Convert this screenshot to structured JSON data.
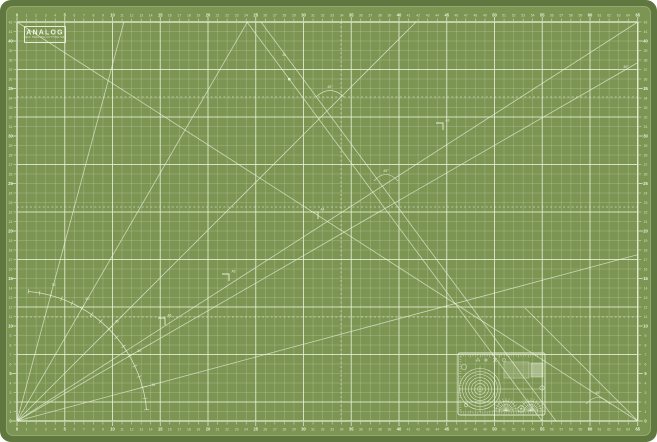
{
  "object": "self-healing cutting mat",
  "colors": {
    "frame_green": "#60783f",
    "surface_green": "#7c9553",
    "ink_white": "#edf4df"
  },
  "logo": {
    "title": "ANALOG",
    "subtitle": "SELF HEALING CUTTING MAT"
  },
  "rulers": {
    "h_min": 0,
    "h_max": 65,
    "v_min": 0,
    "v_max": 42,
    "bold_every": 5
  },
  "protractor": {
    "start_deg": 5,
    "end_deg": 85,
    "tick_step_deg": 5,
    "label_angles_deg": [
      15,
      30,
      45,
      60,
      75
    ],
    "ray_angles_deg": [
      15,
      30,
      45,
      60,
      75
    ]
  },
  "paper_size_markers": [
    {
      "label": "A3"
    },
    {
      "label": "A4"
    },
    {
      "label": "A5"
    },
    {
      "label": "A6"
    }
  ],
  "angle_callouts": [
    {
      "label": "45°"
    },
    {
      "label": "45°"
    },
    {
      "label": "30°"
    },
    {
      "label": "45°"
    },
    {
      "label": "45"
    }
  ]
}
